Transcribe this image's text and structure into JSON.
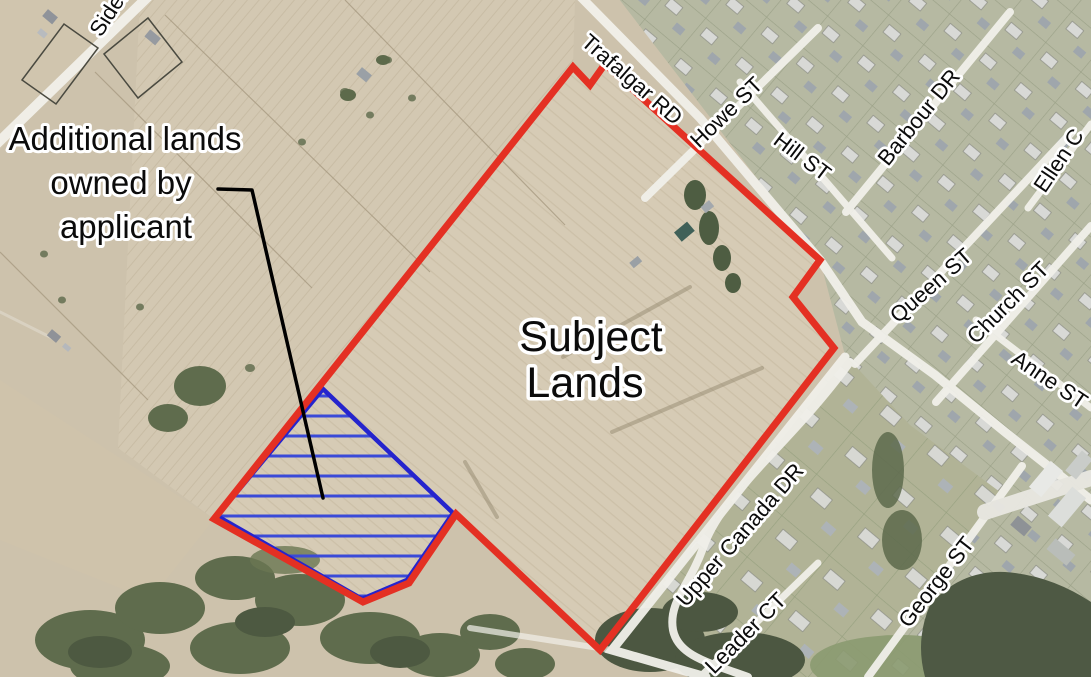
{
  "annotations": {
    "subject_lands_label": {
      "line1": "Subject",
      "line2": "Lands"
    },
    "additional_lands_label": {
      "line1": "Additional lands",
      "line2": "owned by",
      "line3": "applicant"
    }
  },
  "streets": [
    {
      "label": "Sideroad"
    },
    {
      "label": "Trafalgar RD"
    },
    {
      "label": "Howe ST"
    },
    {
      "label": "Hill ST"
    },
    {
      "label": "Barbour DR"
    },
    {
      "label": "Ellen C"
    },
    {
      "label": "Queen ST"
    },
    {
      "label": "Church ST"
    },
    {
      "label": "Anne ST"
    },
    {
      "label": "Upper Canada DR"
    },
    {
      "label": "Leader CT"
    },
    {
      "label": "George ST"
    }
  ],
  "colors": {
    "subject_boundary": "#e43023",
    "additional_outline": "#2524cd",
    "additional_hatch": "#3a4ad8",
    "leader_line": "#000000",
    "label_halo": "#ffffff"
  }
}
